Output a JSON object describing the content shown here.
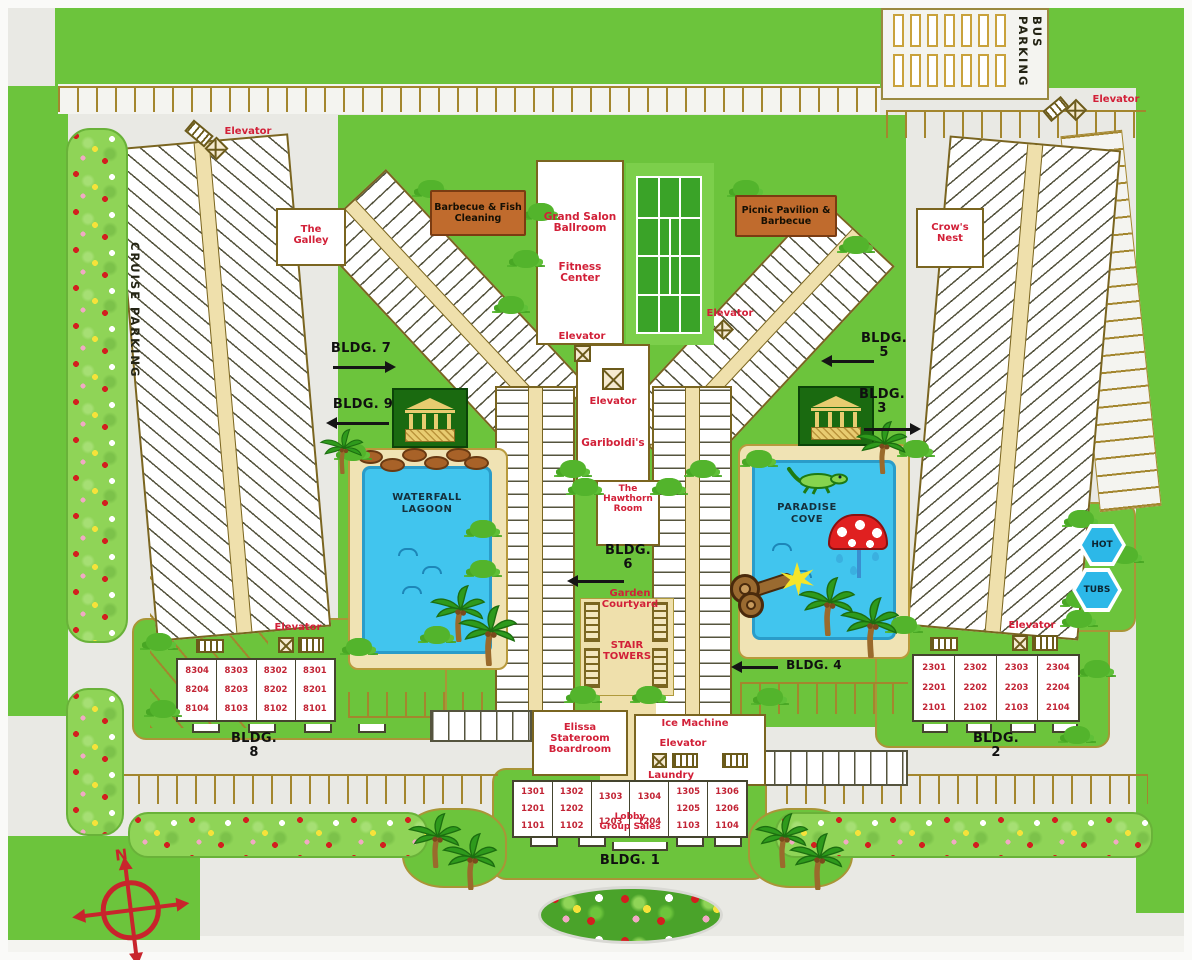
{
  "palette": {
    "grass": "#6cc43c",
    "pool_blue": "#41c5ee",
    "label_red": "#d22038",
    "room_red": "#c22435",
    "corridor_tan": "#efe0ac",
    "sign_brown": "#c06b2d",
    "compass_red": "#c8242c"
  },
  "labels": {
    "elevator": "Elevator",
    "bus_parking": "BUS PARKING",
    "cruise_parking": "CRUISE PARKING",
    "ice_machine": "Ice Machine",
    "laundry": "Laundry",
    "compass_n": "N"
  },
  "signs": {
    "barbecue": [
      "Barbecue & Fish",
      "Cleaning"
    ],
    "picnic": [
      "Picnic Pavilion &",
      "Barbecue"
    ]
  },
  "places": {
    "grand_salon": [
      "Grand Salon",
      "Ballroom"
    ],
    "fitness": [
      "Fitness",
      "Center"
    ],
    "gariboldis": "Gariboldi's",
    "hawthorn": [
      "The",
      "Hawthorn",
      "Room"
    ],
    "galley": [
      "The",
      "Galley"
    ],
    "crows_nest": [
      "Crow's",
      "Nest"
    ],
    "elissa": [
      "Elissa",
      "Stateroom",
      "Boardroom"
    ],
    "garden_courtyard": [
      "Garden",
      "Courtyard"
    ],
    "stair_towers": [
      "STAIR",
      "TOWERS"
    ],
    "lobby": [
      "Lobby",
      "Group Sales"
    ],
    "waterfall_lagoon": [
      "WATERFALL",
      "LAGOON"
    ],
    "paradise_cove": [
      "PARADISE",
      "COVE"
    ],
    "hot": "HOT",
    "tubs": "TUBS"
  },
  "bldg": {
    "b1": "BLDG. 1",
    "b2": [
      "BLDG.",
      "2"
    ],
    "b3": [
      "BLDG.",
      "3"
    ],
    "b4": "BLDG. 4",
    "b5": [
      "BLDG.",
      "5"
    ],
    "b6": [
      "BLDG.",
      "6"
    ],
    "b7": "BLDG. 7",
    "b8": [
      "BLDG.",
      "8"
    ],
    "b9": "BLDG. 9"
  },
  "room_grids": {
    "bldg8": {
      "columns": [
        [
          "8304",
          "8204",
          "8104"
        ],
        [
          "8303",
          "8203",
          "8103"
        ],
        [
          "8302",
          "8202",
          "8102"
        ],
        [
          "8301",
          "8201",
          "8101"
        ]
      ]
    },
    "bldg2": {
      "columns": [
        [
          "2301",
          "2201",
          "2101"
        ],
        [
          "2302",
          "2202",
          "2102"
        ],
        [
          "2303",
          "2203",
          "2103"
        ],
        [
          "2304",
          "2204",
          "2104"
        ]
      ]
    },
    "bldg1": {
      "columns": [
        [
          "1301",
          "1201",
          "1101"
        ],
        [
          "1302",
          "1202",
          "1102"
        ],
        [
          "1303",
          "1203"
        ],
        [
          "1304",
          "1204"
        ],
        [
          "1305",
          "1205",
          "1103"
        ],
        [
          "1306",
          "1206",
          "1104"
        ]
      ]
    }
  }
}
